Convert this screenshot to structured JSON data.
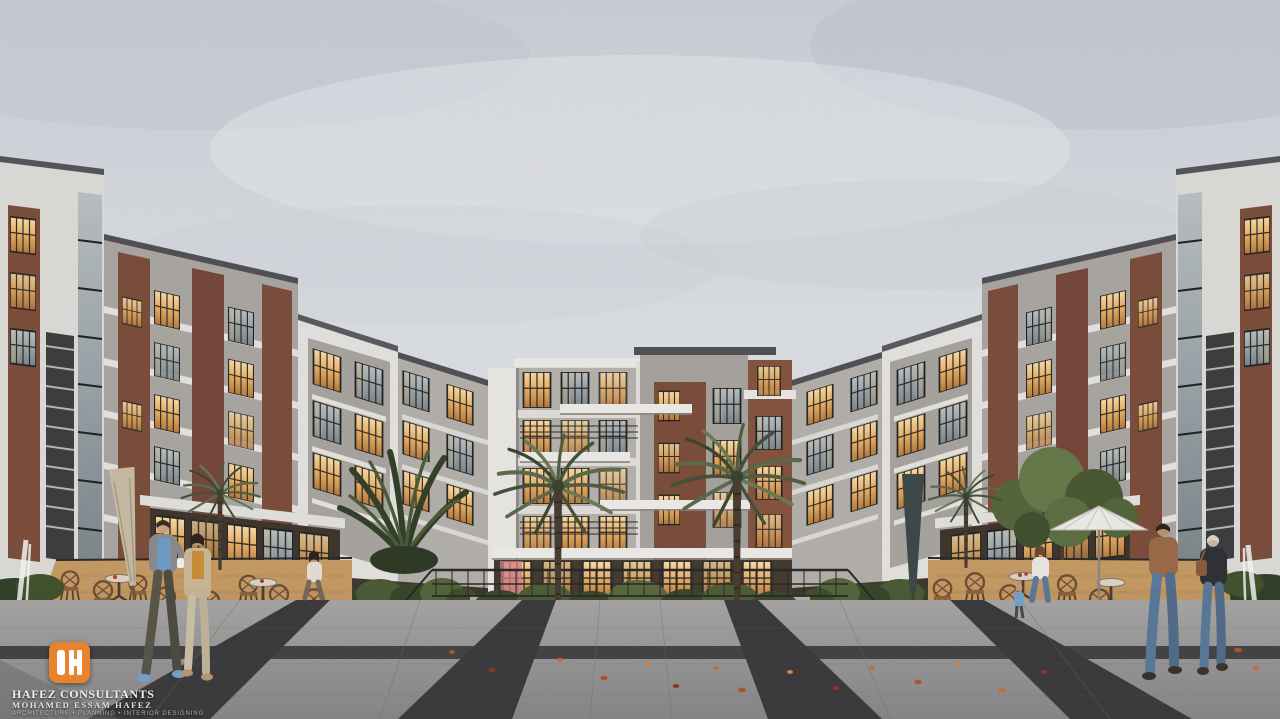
{
  "scene": {
    "title": "Courtyard view — modern residential compound at dusk, architectural rendering",
    "sky": "overcast light gray",
    "elements": {
      "buildings": "U-shaped apartment blocks in brick, gray and white concrete with warm glowing windows",
      "palms": "two tall date palms flanking the central block, smaller palms by the cafes",
      "cafe_left": "outdoor cafe with wicker bistro chairs, round tables and a closed beige umbrella",
      "cafe_right": "outdoor cafe with wicker chairs, open white umbrella, leafy tree and closed dark umbrella",
      "water": "reflecting pools, waterfall planters and white fountain jets at both edges",
      "plaza": "light granite plaza with dark diagonal inlay bands and scattered autumn leaves",
      "people": [
        "man in gray jacket and blue shirt walking with coffee cup",
        "woman in mustard top and beige cardigan walking",
        "woman seated at left cafe table",
        "woman in white sweater seated at right cafe table",
        "man in brown leather jacket walking away",
        "woman in dark jacket with shoulder bag walking away"
      ]
    }
  },
  "branding": {
    "monogram": "H",
    "company": "HAFEZ CONSULTANTS",
    "principal": "MOHAMED ESSAM HAFEZ",
    "tagline": "ARCHITECTURE • PLANNING • INTERIOR DESIGNING",
    "colors": {
      "logo_bg": "#e8822c",
      "logo_mark": "#ffffff",
      "company_text": "#f2f0ec",
      "tagline_text": "#b7b3ae"
    }
  },
  "palette": {
    "sky": "#d5d8dd",
    "cloud": "#c6cad2",
    "concrete_white": "#e8e6e2",
    "concrete_gray": "#a7a39e",
    "brick": "#7c4e3c",
    "window_glow": "#f2c27c",
    "glass_cool": "#9fa8ae",
    "roof_dark": "#515156",
    "foliage_dark": "#2f3b27",
    "foliage_mid": "#4c5c38",
    "palm_frond": "#5e6a4c",
    "cafe_deck": "#c59a64",
    "chair_wicker": "#7a5639",
    "plaza_light": "#a5a4a3",
    "plaza_dark_band": "#3d3d3f",
    "water_pool": "#7fb5c4",
    "leaves_accent": "#c9713a"
  }
}
